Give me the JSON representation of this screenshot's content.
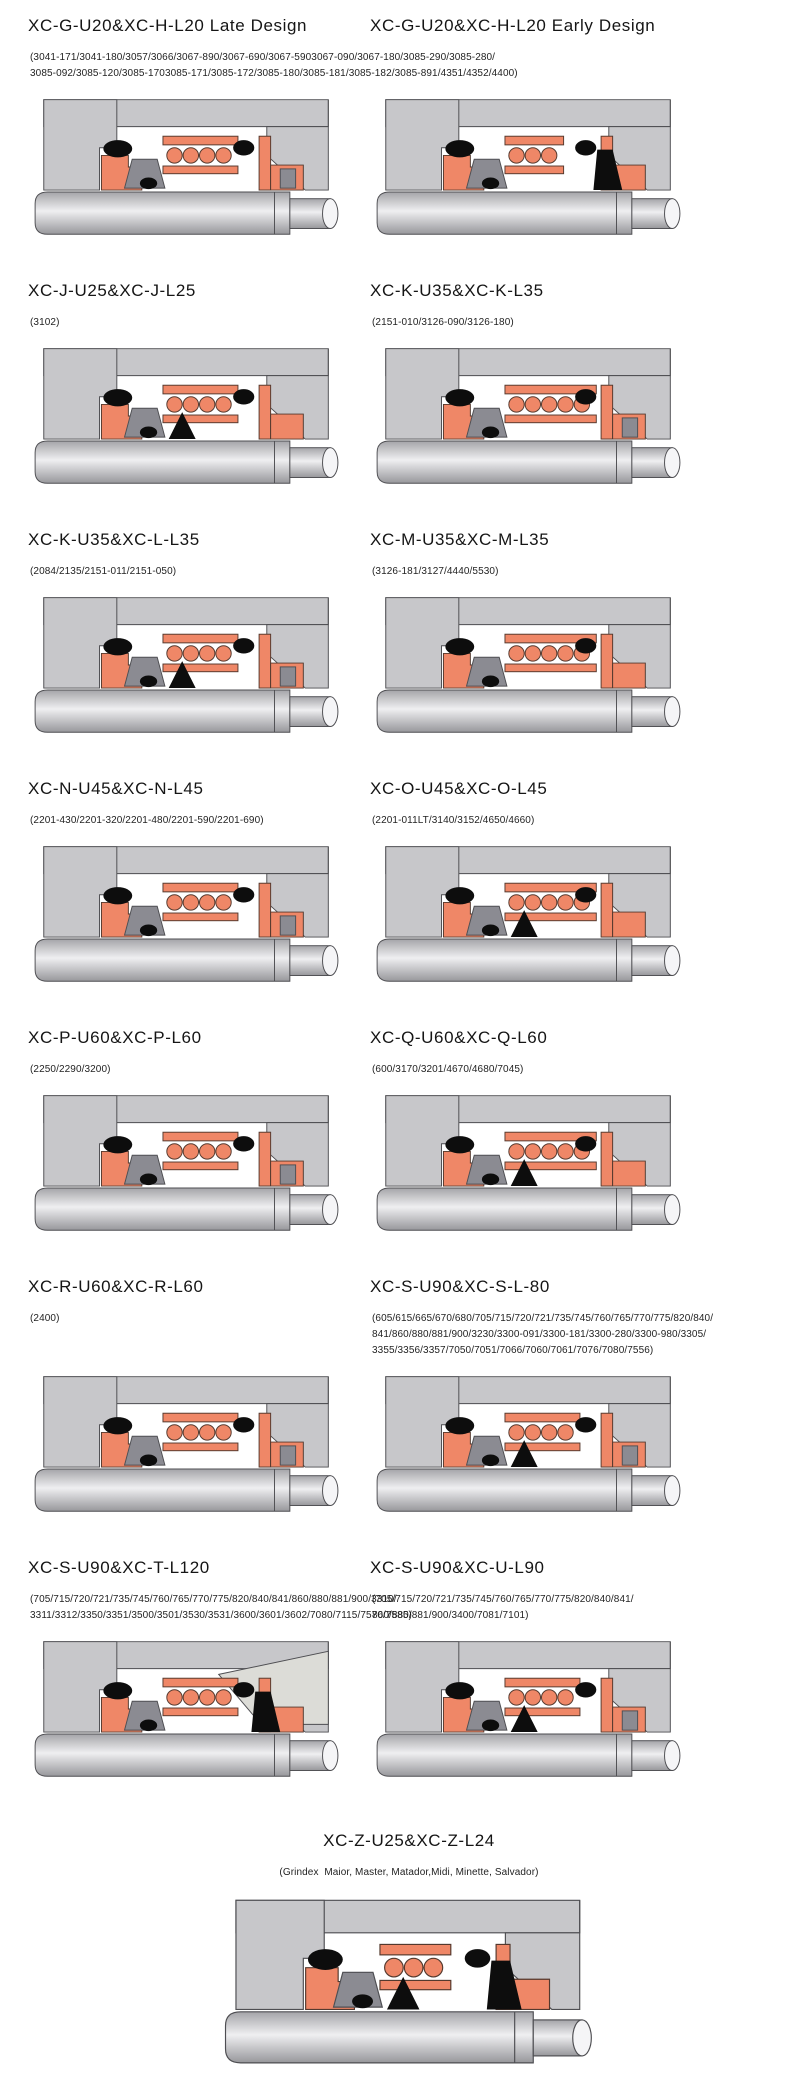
{
  "page": {
    "kind": "mechanical-seal-catalog-page",
    "background": "#ffffff"
  },
  "colors": {
    "housing_gray": "#c7c7ca",
    "outline": "#4e4e52",
    "seal_orange": "#ef8767",
    "seal_outline": "#54392e",
    "mid_gray": "#8b8b92",
    "black": "#0d0d0d",
    "wedge_gray": "#dcdcd7",
    "shaft_dark": "#a4a4a8",
    "shaft_light": "#efeff1",
    "shaft_cap": "#f5f5f7"
  },
  "sections": [
    {
      "id": "xc-g-late",
      "title": "XC-G-U20&XC-H-L20 Late Design",
      "parts": "(3041-171/3041-180/3057/3066/3067-890/3067-690/3067-5903067-090/3067-180/3085-290/3085-280/\n3085-092/3085-120/3085-1703085-171/3085-172/3085-180/3085-181/3085-182/3085-891/4351/4352/4400)",
      "diagram": "seal-cross-section-diagram",
      "variant": {
        "coils": 4,
        "bellows": false,
        "rightGray": true
      }
    },
    {
      "id": "xc-g-early",
      "title": "XC-G-U20&XC-H-L20 Early Design",
      "parts": "",
      "diagram": "seal-cross-section-diagram",
      "variant": {
        "coils": 3,
        "bellows": false,
        "rightGray": false,
        "darkSeat": true
      }
    },
    {
      "id": "xc-j",
      "title": "XC-J-U25&XC-J-L25",
      "parts": "(3102)",
      "diagram": "seal-cross-section-diagram",
      "variant": {
        "coils": 4,
        "bellows": true,
        "rightGray": false
      }
    },
    {
      "id": "xc-k",
      "title": "XC-K-U35&XC-K-L35",
      "parts": "(2151-010/3126-090/3126-180)",
      "diagram": "seal-cross-section-diagram",
      "variant": {
        "coils": 5,
        "bellows": false,
        "rightGray": true
      }
    },
    {
      "id": "xc-k-l",
      "title": "XC-K-U35&XC-L-L35",
      "parts": "(2084/2135/2151-011/2151-050)",
      "diagram": "seal-cross-section-diagram",
      "variant": {
        "coils": 4,
        "bellows": true,
        "rightGray": true
      }
    },
    {
      "id": "xc-m",
      "title": "XC-M-U35&XC-M-L35",
      "parts": "(3126-181/3127/4440/5530)",
      "diagram": "seal-cross-section-diagram",
      "variant": {
        "coils": 5,
        "bellows": false,
        "rightGray": false
      }
    },
    {
      "id": "xc-n",
      "title": "XC-N-U45&XC-N-L45",
      "parts": "(2201-430/2201-320/2201-480/2201-590/2201-690)",
      "diagram": "seal-cross-section-diagram",
      "variant": {
        "coils": 4,
        "bellows": false,
        "rightGray": true
      }
    },
    {
      "id": "xc-o",
      "title": "XC-O-U45&XC-O-L45",
      "parts": "(2201-011LT/3140/3152/4650/4660)",
      "diagram": "seal-cross-section-diagram",
      "variant": {
        "coils": 5,
        "bellows": true,
        "rightGray": false
      }
    },
    {
      "id": "xc-p",
      "title": "XC-P-U60&XC-P-L60",
      "parts": "(2250/2290/3200)",
      "diagram": "seal-cross-section-diagram",
      "variant": {
        "coils": 4,
        "bellows": false,
        "rightGray": true
      }
    },
    {
      "id": "xc-q",
      "title": "XC-Q-U60&XC-Q-L60",
      "parts": "(600/3170/3201/4670/4680/7045)",
      "diagram": "seal-cross-section-diagram",
      "variant": {
        "coils": 5,
        "bellows": true,
        "rightGray": false
      }
    },
    {
      "id": "xc-r",
      "title": "XC-R-U60&XC-R-L60",
      "parts": "(2400)",
      "diagram": "seal-cross-section-diagram",
      "variant": {
        "coils": 4,
        "bellows": false,
        "rightGray": true
      }
    },
    {
      "id": "xc-s-l80",
      "title": "XC-S-U90&XC-S-L-80",
      "parts": "(605/615/665/670/680/705/715/720/721/735/745/760/765/770/775/820/840/\n841/860/880/881/900/3230/3300-091/3300-181/3300-280/3300-980/3305/\n3355/3356/3357/7050/7051/7066/7060/7061/7076/7080/7556)",
      "diagram": "seal-cross-section-diagram",
      "variant": {
        "coils": 4,
        "bellows": true,
        "rightGray": true
      }
    },
    {
      "id": "xc-t-l120",
      "title": "XC-S-U90&XC-T-L120",
      "parts": "(705/715/720/721/735/745/760/765/770/775/820/840/841/860/880/881/900/3310/\n3311/3312/3350/3351/3500/3501/3530/3531/3600/3601/3602/7080/7115/7570/7585)",
      "diagram": "seal-cross-section-diagram",
      "variant": {
        "coils": 4,
        "bellows": false,
        "wedge": true,
        "darkSeat": true
      }
    },
    {
      "id": "xc-u-l90",
      "title": "XC-S-U90&XC-U-L90",
      "parts": "(705/715/720/721/735/745/760/765/770/775/820/840/841/\n860/880/881/900/3400/7081/7101)",
      "diagram": "seal-cross-section-diagram",
      "variant": {
        "coils": 4,
        "bellows": true,
        "rightGray": true
      }
    },
    {
      "id": "xc-z",
      "title": "XC-Z-U25&XC-Z-L24",
      "parts": "(Grindex  Maior, Master, Matador,Midi, Minette, Salvador)",
      "diagram": "seal-cross-section-diagram",
      "variant": {
        "coils": 3,
        "bellows": true,
        "rightGray": false,
        "darkSeat": true,
        "wide": true
      },
      "align": "center"
    }
  ]
}
